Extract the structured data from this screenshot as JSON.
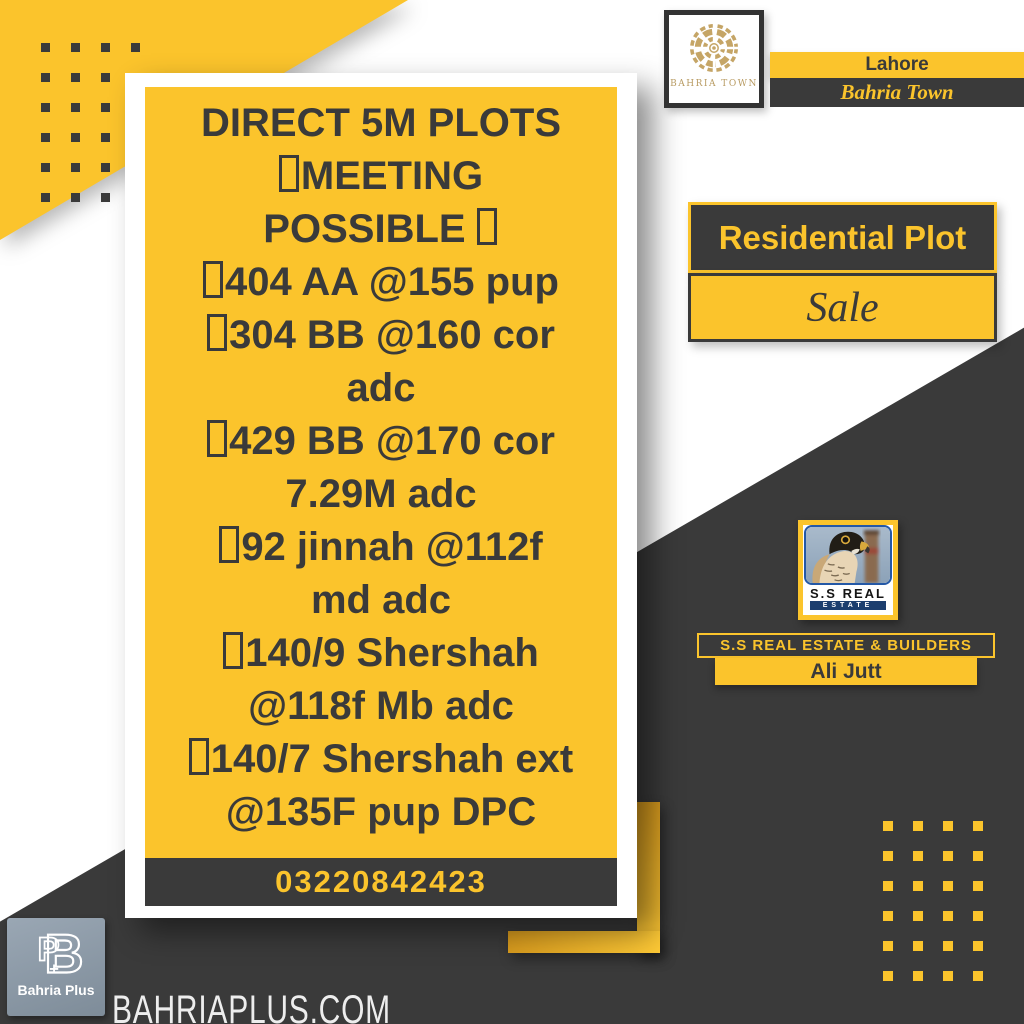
{
  "colors": {
    "yellow": "#FBC42C",
    "dark": "#3A3A3A",
    "gold": "#C5A566",
    "navy": "#1C3E6E",
    "light": "#EDEDED"
  },
  "card": {
    "lines": [
      "DIRECT 5M PLOTS",
      "☐MEETING",
      "POSSIBLE ☐",
      "☐404 AA @155 pup",
      "☐304 BB @160 cor",
      "adc",
      "☐429 BB @170 cor",
      "7.29M adc",
      "☐92 jinnah @112f",
      "md adc",
      "☐140/9 Shershah",
      "@118f Mb adc",
      "☐140/7 Shershah ext",
      "@135F pup DPC"
    ],
    "phone": "03220842423"
  },
  "brand_top": {
    "logo_caption": "BAHRIA TOWN",
    "city": "Lahore",
    "name": "Bahria Town"
  },
  "listing": {
    "type": "Residential Plot",
    "status": "Sale"
  },
  "agency": {
    "logo_line1": "S.S REAL",
    "logo_line2": "ESTATE",
    "bar": "S.S REAL ESTATE & BUILDERS",
    "agent": "Ali Jutt"
  },
  "footer": {
    "site": "BAHRIAPLUS.COM",
    "logo_caption": "Bahria Plus"
  }
}
